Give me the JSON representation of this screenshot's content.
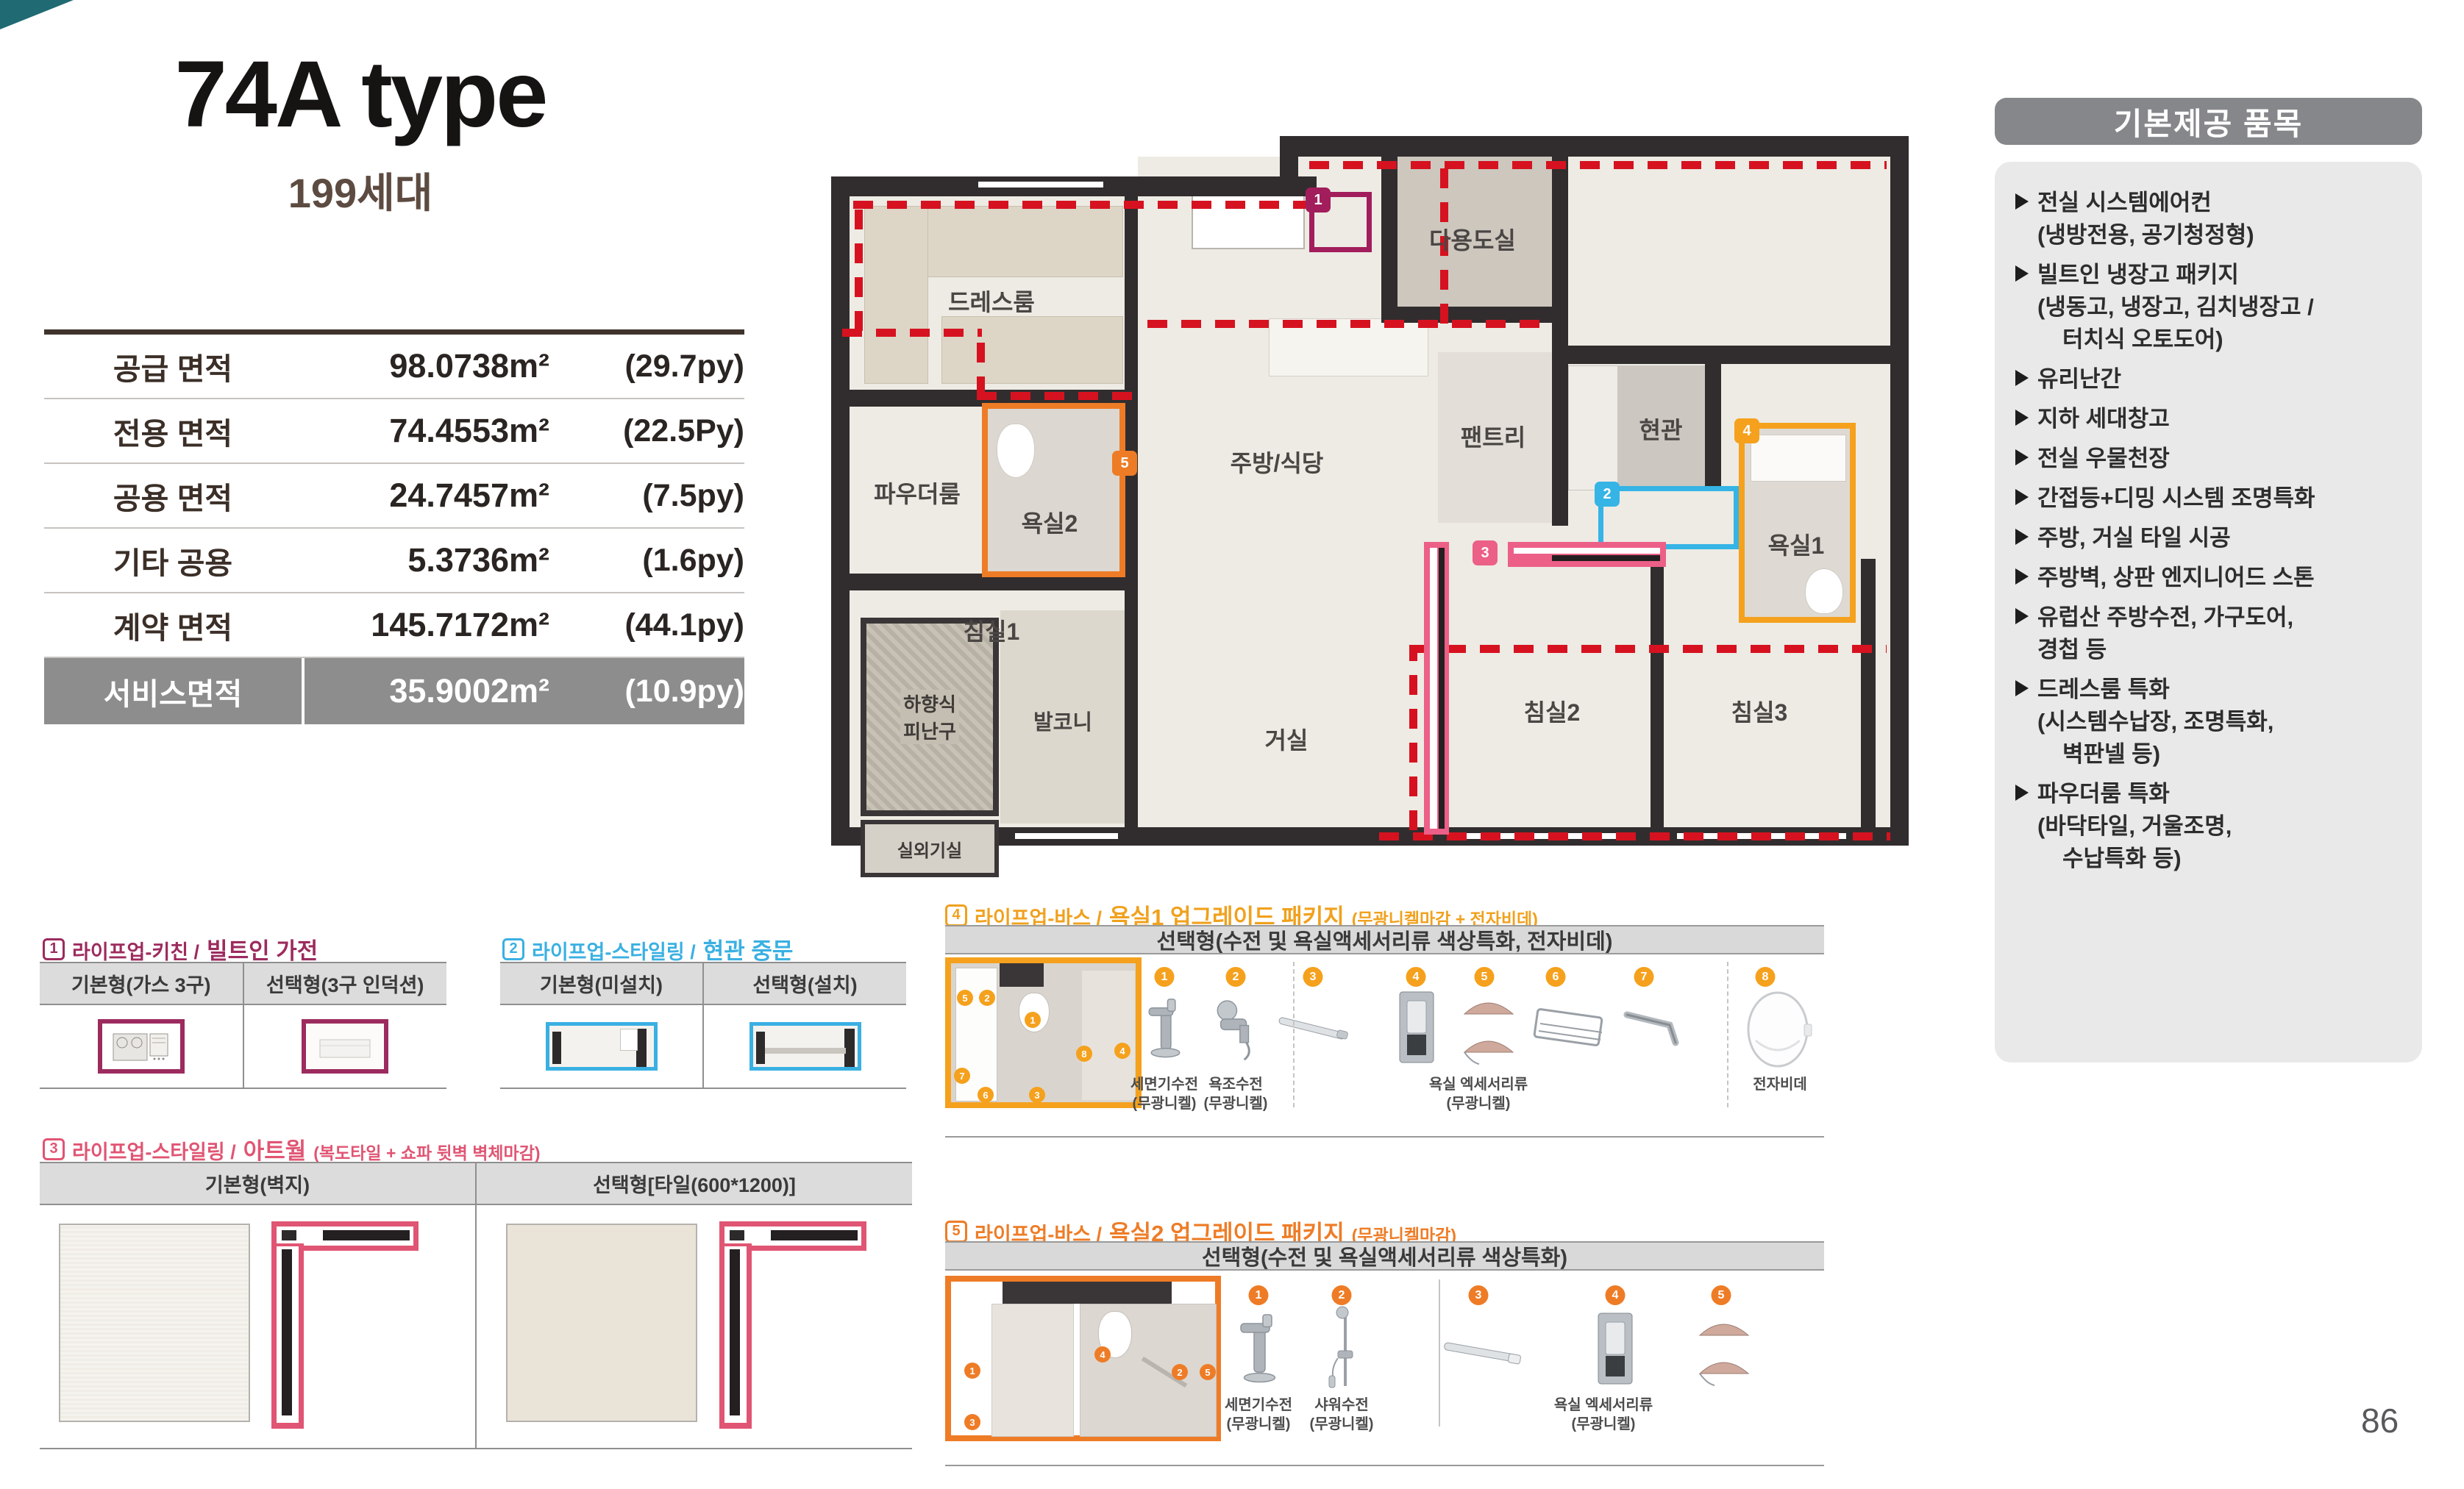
{
  "page_number": "86",
  "colors": {
    "accent_magenta": "#a21d5c",
    "accent_cyan": "#35b4e5",
    "accent_pink": "#ec5f87",
    "accent_yellow_orange": "#f5a11d",
    "accent_orange": "#ee7c26",
    "service_dash_red": "#d61220",
    "service_row_bg": "#8d8d8d",
    "corner_accent": "#1f6a73"
  },
  "header": {
    "title": "74A type",
    "households": "199세대"
  },
  "area_table": {
    "rows": [
      {
        "label": "공급 면적",
        "m2": "98.0738m²",
        "py": "(29.7py)"
      },
      {
        "label": "전용 면적",
        "m2": "74.4553m²",
        "py": "(22.5Py)"
      },
      {
        "label": "공용 면적",
        "m2": "24.7457m²",
        "py": "(7.5py)"
      },
      {
        "label": "기타 공용",
        "m2": "5.3736m²",
        "py": "(1.6py)"
      },
      {
        "label": "계약 면적",
        "m2": "145.7172m²",
        "py": "(44.1py)"
      },
      {
        "label": "서비스면적",
        "m2": "35.9002m²",
        "py": "(10.9py)"
      }
    ]
  },
  "floor_plan": {
    "rooms": {
      "dress": "드레스룸",
      "powder": "파우더룸",
      "bath2": "욕실2",
      "kitchen": "주방/식당",
      "utility": "다용도실",
      "pantry": "팬트리",
      "entry": "현관",
      "bath1": "욕실1",
      "bed1": "침실1",
      "living": "거실",
      "bed2": "침실2",
      "bed3": "침실3",
      "balcony": "발코니",
      "escape_line1": "하향식",
      "escape_line2": "피난구",
      "outdoor_unit": "실외기실"
    },
    "markers": {
      "m1": "1",
      "m2": "2",
      "m3": "3",
      "m4": "4",
      "m5": "5"
    }
  },
  "provided": {
    "title": "기본제공 품목",
    "items": [
      {
        "main": "전실 시스템에어컨",
        "subs": [
          "(냉방전용, 공기청정형)"
        ]
      },
      {
        "main": "빌트인 냉장고 패키지",
        "subs": [
          "(냉동고, 냉장고, 김치냉장고 /",
          "터치식 오토도어)"
        ]
      },
      {
        "main": "유리난간",
        "subs": []
      },
      {
        "main": "지하 세대창고",
        "subs": []
      },
      {
        "main": "전실 우물천장",
        "subs": []
      },
      {
        "main": "간접등+디밍 시스템 조명특화",
        "subs": []
      },
      {
        "main": "주방, 거실 타일 시공",
        "subs": []
      },
      {
        "main": "주방벽, 상판 엔지니어드 스톤",
        "subs": []
      },
      {
        "main": "유럽산 주방수전, 가구도어,",
        "subs": [
          "경첩 등"
        ]
      },
      {
        "main": "드레스룸 특화",
        "subs": [
          "(시스템수납장, 조명특화,",
          "벽판넬 등)"
        ]
      },
      {
        "main": "파우더룸 특화",
        "subs": [
          "(바닥타일, 거울조명,",
          "수납특화 등)"
        ]
      }
    ]
  },
  "sections": {
    "s1": {
      "num": "1",
      "cat": "라이프업-키친 /",
      "name": "빌트인 가전",
      "col1": "기본형(가스 3구)",
      "col2": "선택형(3구 인덕션)"
    },
    "s2": {
      "num": "2",
      "cat": "라이프업-스타일링 /",
      "name": "현관 중문",
      "col1": "기본형(미설치)",
      "col2": "선택형(설치)"
    },
    "s3": {
      "num": "3",
      "cat": "라이프업-스타일링 /",
      "name": "아트월",
      "note": "(복도타일 + 쇼파 뒷벽 벽체마감)",
      "col1": "기본형(벽지)",
      "col2": "선택형[타일(600*1200)]"
    },
    "s4": {
      "num": "4",
      "cat": "라이프업-바스 /",
      "name": "욕실1 업그레이드 패키지",
      "note": "(무광니켈마감 + 전자비데)",
      "header": "선택형(수전 및 욕실액세서리류 색상특화, 전자비데)",
      "nums": [
        "1",
        "2",
        "3",
        "4",
        "5",
        "6",
        "7",
        "8"
      ],
      "labels": [
        {
          "name": "세면기수전",
          "finish": "(무광니켈)"
        },
        {
          "name": "욕조수전",
          "finish": "(무광니켈)"
        },
        {
          "name": "욕실 엑세서리류",
          "finish": "(무광니켈)"
        },
        {
          "name": "전자비데",
          "finish": ""
        }
      ]
    },
    "s5": {
      "num": "5",
      "cat": "라이프업-바스 /",
      "name": "욕실2 업그레이드 패키지",
      "note": "(무광니켈마감)",
      "header": "선택형(수전 및 욕실액세서리류 색상특화)",
      "nums": [
        "1",
        "2",
        "3",
        "4",
        "5"
      ],
      "labels": [
        {
          "name": "세면기수전",
          "finish": "(무광니켈)"
        },
        {
          "name": "샤워수전",
          "finish": "(무광니켈)"
        },
        {
          "name": "욕실 엑세서리류",
          "finish": "(무광니켈)"
        }
      ]
    }
  }
}
